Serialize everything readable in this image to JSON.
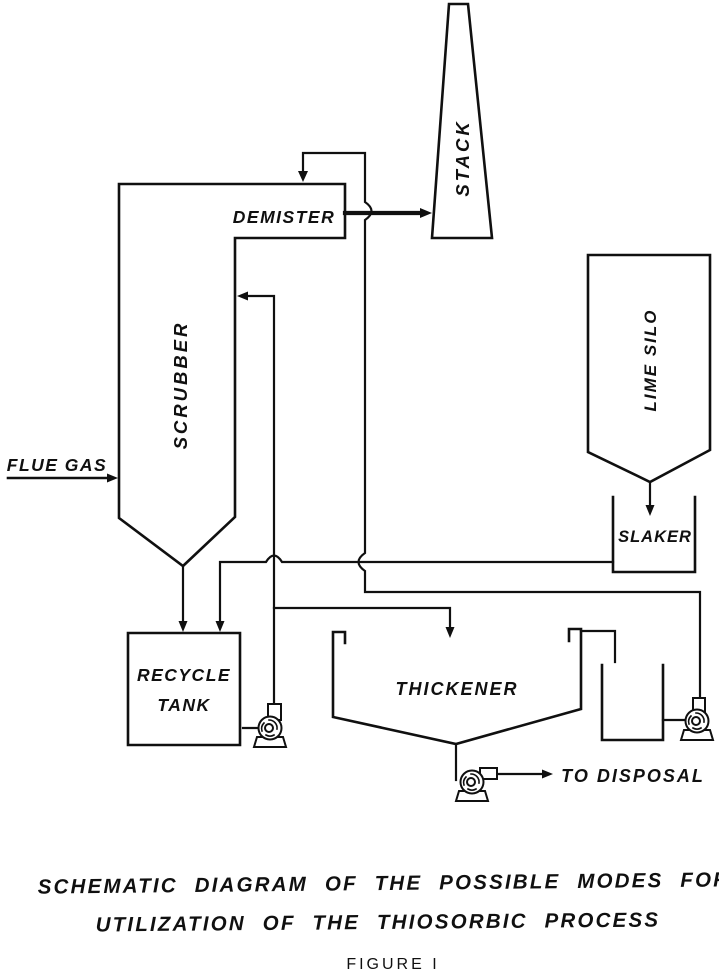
{
  "figure": {
    "caption_line1": "SCHEMATIC DIAGRAM OF THE POSSIBLE MODES FOR",
    "caption_line2": "UTILIZATION OF THE THIOSORBIC PROCESS",
    "figure_label": "FIGURE I"
  },
  "diagram": {
    "ink_color": "#101010",
    "background_color": "#ffffff",
    "labels": {
      "flue_gas": "FLUE GAS",
      "demister": "DEMISTER",
      "stack": "STACK",
      "scrubber": "SCRUBBER",
      "lime_silo": "LIME SILO",
      "slaker": "SLAKER",
      "recycle_tank_line1": "RECYCLE",
      "recycle_tank_line2": "TANK",
      "thickener": "THICKENER",
      "to_disposal": "TO DISPOSAL"
    }
  }
}
